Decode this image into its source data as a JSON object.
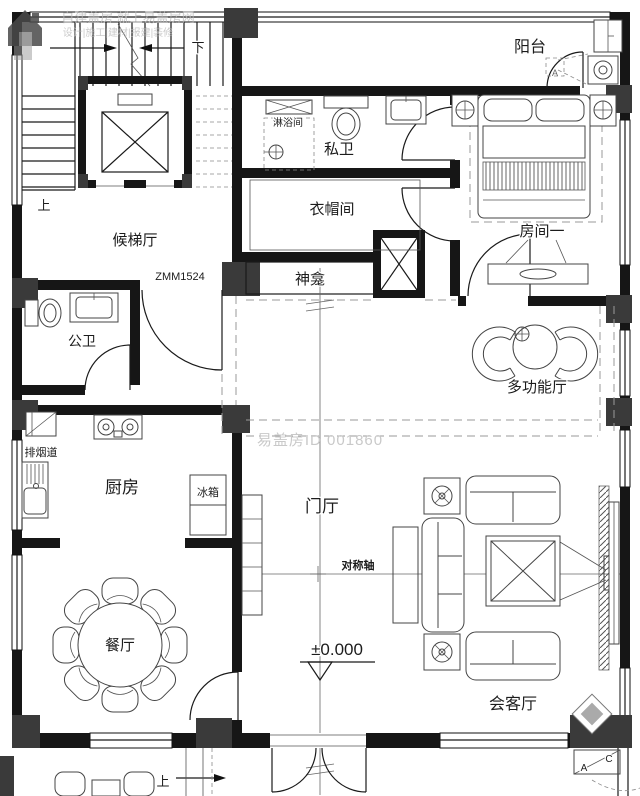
{
  "plan": {
    "rooms": {
      "balcony": "阳台",
      "bedroom": "房间一",
      "private_bath": "私卫",
      "shower": "淋浴间",
      "cloakroom": "衣帽间",
      "shrine": "神龛",
      "elevator_hall": "候梯厅",
      "public_bath": "公卫",
      "multifunction_hall": "多功能厅",
      "kitchen": "厨房",
      "foyer": "门厅",
      "dining": "餐厅",
      "reception": "会客厅"
    },
    "fixtures": {
      "fridge": "冰箱",
      "smoke_duct": "排烟道"
    },
    "annotations": {
      "door_tag": "ZMM1524",
      "symmetry_axis": "对称轴",
      "elevation": "±0.000",
      "stairs_up_inner": "上",
      "stairs_down": "下",
      "entrance_up": "上",
      "section_a": "A",
      "section_c": "C",
      "balcony_marker": "A"
    },
    "watermarks": {
      "id_text": "易盖房ID 001860",
      "brand_line1": "自建盖房 就上易盖房网",
      "brand_line2": "设计|施工|建材|报建|装修"
    },
    "colors": {
      "line": "#1a1a1a",
      "column": "#3a3a3a",
      "dashed": "#9a9a9a",
      "watermark": "#c9c9c9"
    }
  }
}
